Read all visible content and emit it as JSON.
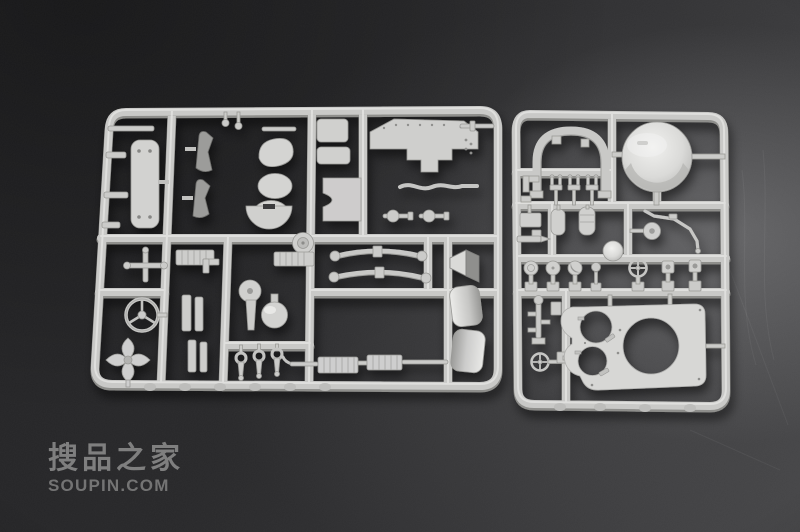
{
  "scene": {
    "subject": "two light-gray plastic model-kit sprues on dark slate surface",
    "plastic_color": "#c9c9c7",
    "plastic_highlight": "#e6e6e4",
    "plastic_shadow": "#8e8e8b",
    "background_dark": "#232325",
    "background_light": "#565658",
    "left_sprue_label": "large parts sprue (hull plates, fenders, leaf springs, fittings)",
    "right_sprue_label": "small parts sprue (turret roof plate, cupola dome, fittings)"
  },
  "watermark": {
    "title": "搜品之家",
    "subtitle": "SOUPIN.COM",
    "color": "#8a8a8a"
  }
}
